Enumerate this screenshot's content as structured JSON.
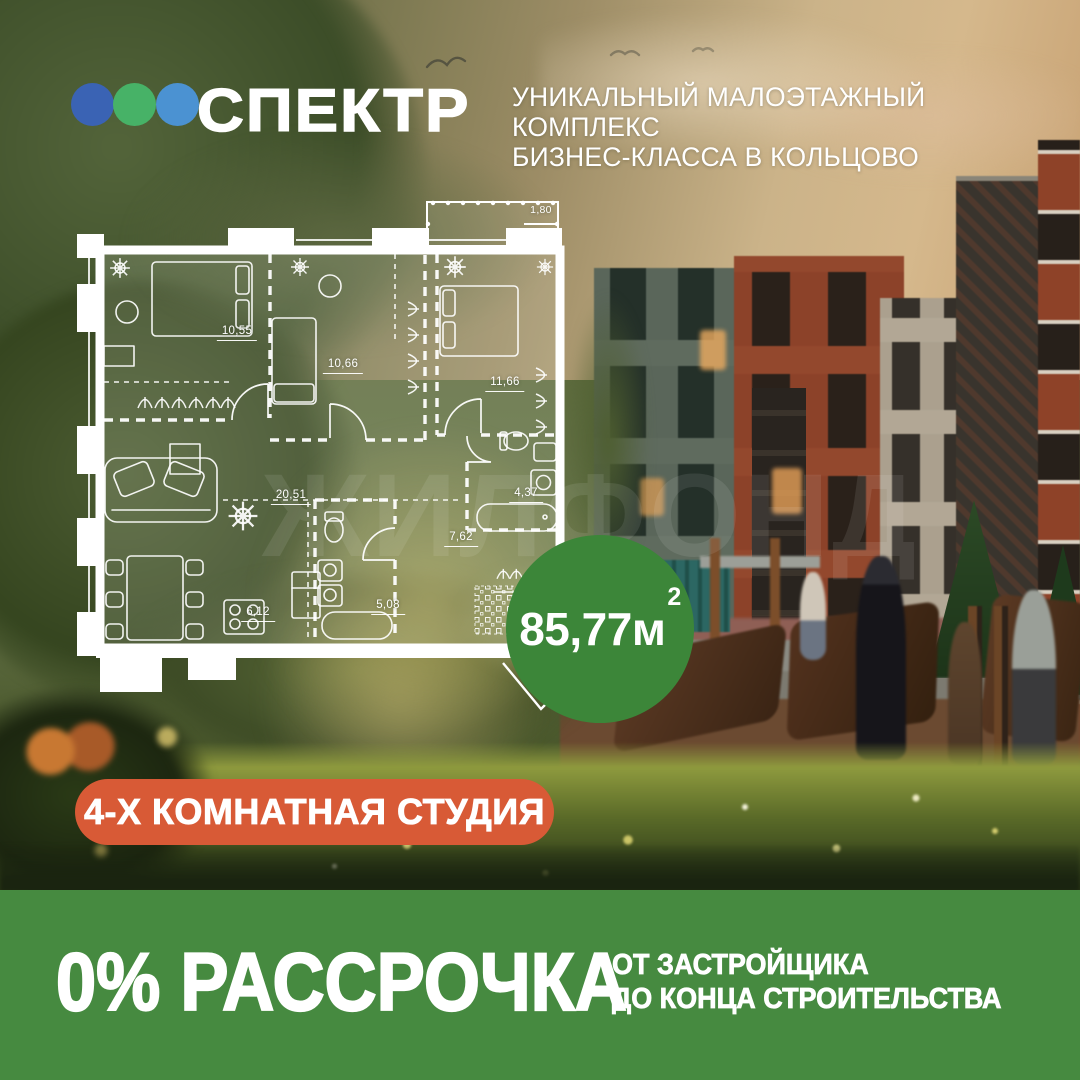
{
  "header": {
    "logo": {
      "text": "СПЕКТР",
      "dots": [
        {
          "name": "dot-dark-blue",
          "color": "#3a63b4"
        },
        {
          "name": "dot-green",
          "color": "#47b267"
        },
        {
          "name": "dot-light-blue",
          "color": "#4b92d2"
        }
      ]
    },
    "tagline": {
      "line1": "УНИКАЛЬНЫЙ МАЛОЭТАЖНЫЙ КОМПЛЕКС",
      "line2": "БИЗНЕС-КЛАССА В КОЛЬЦОВО"
    }
  },
  "floor_plan": {
    "rooms": [
      {
        "id": "bedroom-1",
        "area": "10,55"
      },
      {
        "id": "bedroom-2",
        "area": "10,66"
      },
      {
        "id": "bedroom-3",
        "area": "11,66"
      },
      {
        "id": "living-room",
        "area": "20,51"
      },
      {
        "id": "kitchen",
        "area": "6,12"
      },
      {
        "id": "bathroom-1",
        "area": "5,08"
      },
      {
        "id": "hallway",
        "area": "7,62"
      },
      {
        "id": "bathroom-2",
        "area": "4,37"
      },
      {
        "id": "entry",
        "area": "7,39"
      },
      {
        "id": "balcony",
        "area": "1,80"
      }
    ],
    "total_area": {
      "value": "85,77м",
      "superscript": "2"
    },
    "apartment_type": "4-Х КОМНАТНАЯ СТУДИЯ"
  },
  "watermark": "ЖИЛФОНД",
  "footer": {
    "offer": "0% РАССРОЧКА",
    "detail_line1": "ОТ ЗАСТРОЙЩИКА",
    "detail_line2": "ДО КОНЦА СТРОИТЕЛЬСТВА"
  },
  "colors": {
    "footer_green": "#468a40",
    "area_badge_green": "#3c8639",
    "type_badge_orange": "#d85a36",
    "plan_lines_white": "#ffffff"
  }
}
